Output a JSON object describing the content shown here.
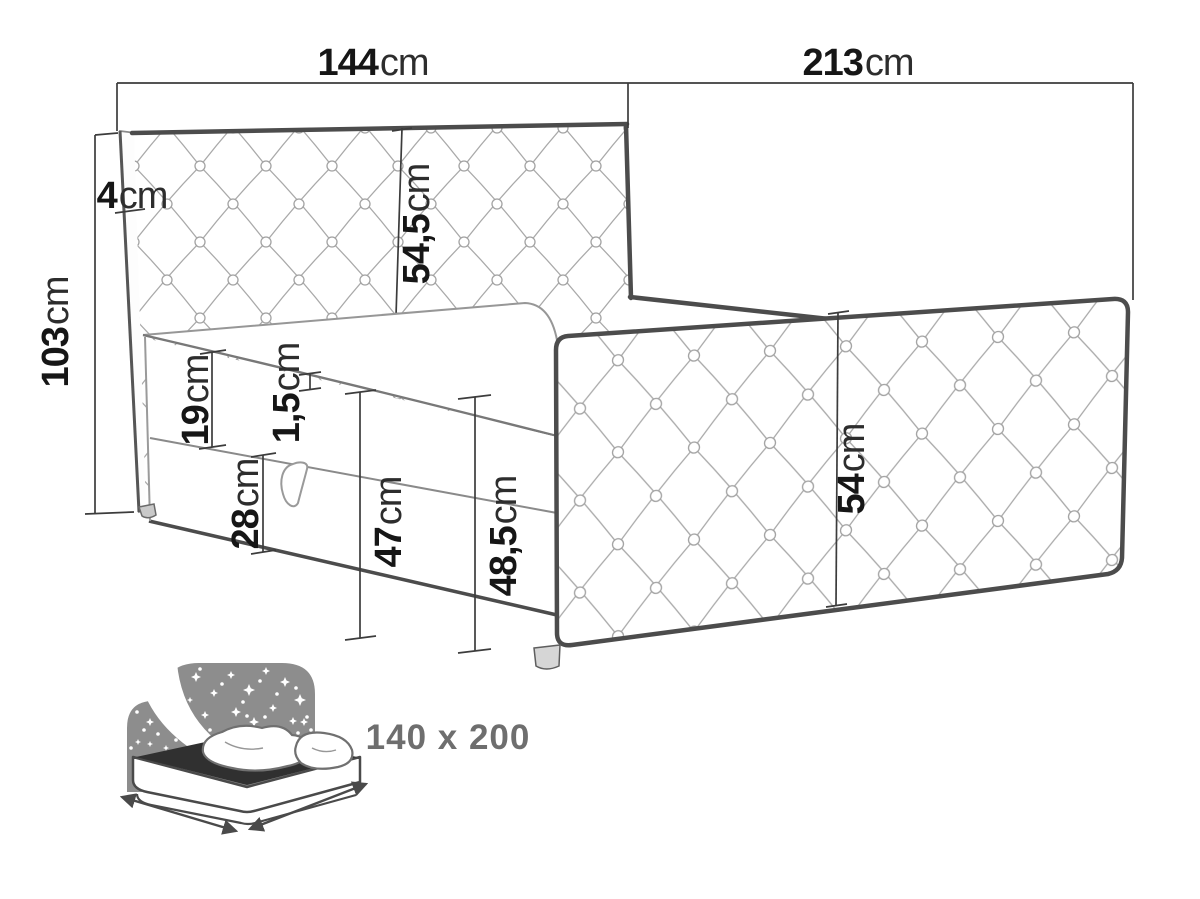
{
  "measurements": {
    "headboard_width": {
      "value": "144",
      "unit": "cm"
    },
    "bed_length": {
      "value": "213",
      "unit": "cm"
    },
    "total_height": {
      "value": "103",
      "unit": "cm"
    },
    "headboard_thickness": {
      "value": "4",
      "unit": "cm"
    },
    "headboard_panel_height": {
      "value": "54,5",
      "unit": "cm"
    },
    "mattress_height": {
      "value": "19",
      "unit": "cm"
    },
    "topper_seam_height": {
      "value": "1,5",
      "unit": "cm"
    },
    "base_height": {
      "value": "28",
      "unit": "cm"
    },
    "side_height": {
      "value": "47",
      "unit": "cm"
    },
    "side_total_height": {
      "value": "48,5",
      "unit": "cm"
    },
    "side_rail_height": {
      "value": "54",
      "unit": "cm"
    }
  },
  "mattress_size_badge": {
    "label": "140 x 200"
  },
  "colors": {
    "outline": "#4c4c4c",
    "tufting_line": "#a9a9a9",
    "dimension_line": "#3c3c3c",
    "label_text": "#161616",
    "icon_gray": "#8d8d8d",
    "icon_dark": "#303030",
    "icon_text": "#6e6e6e"
  }
}
